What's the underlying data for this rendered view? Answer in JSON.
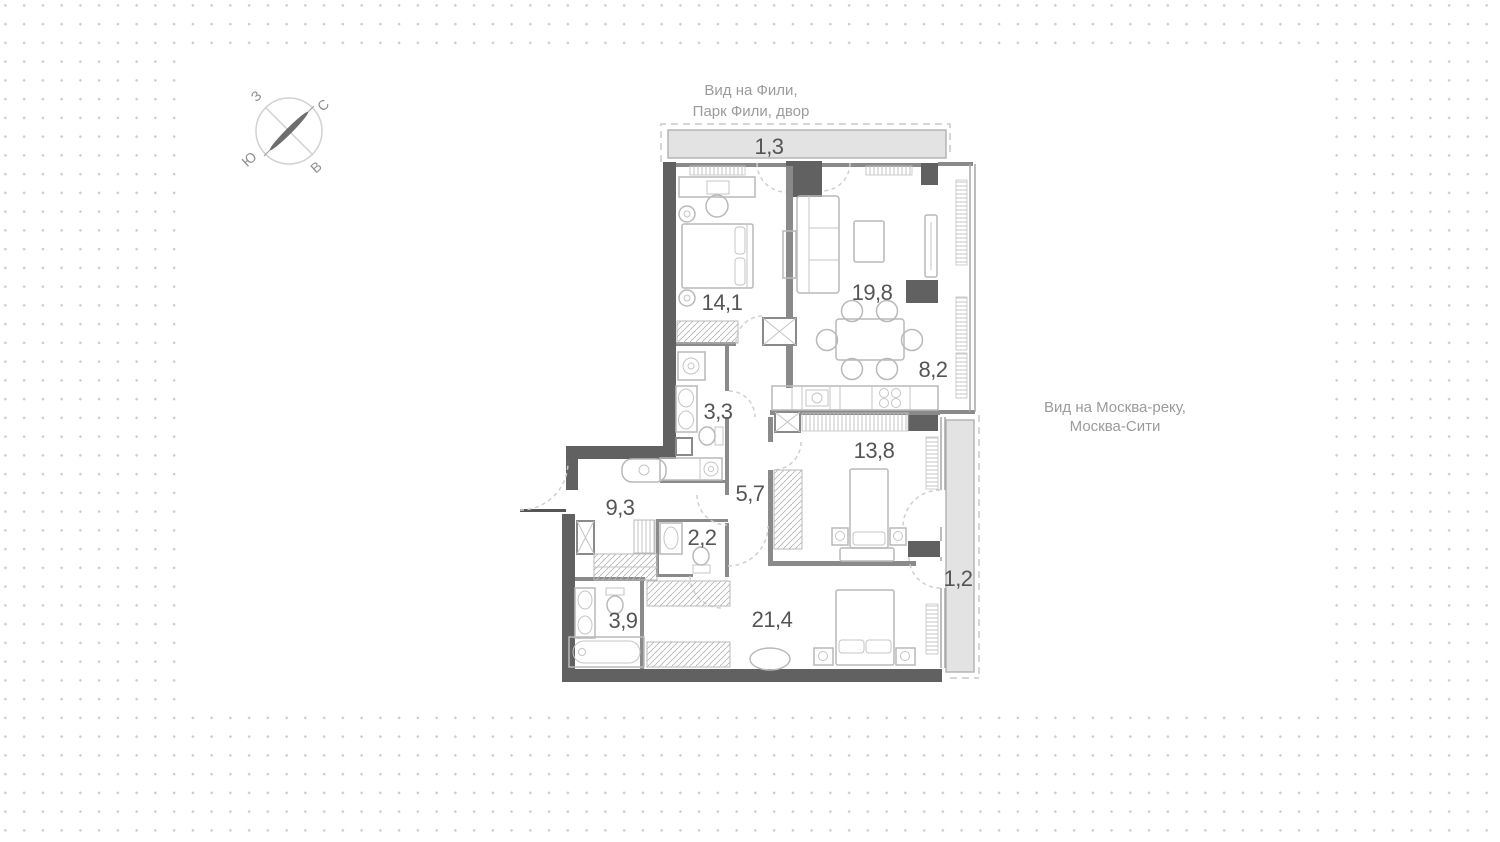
{
  "canvas": {
    "width": 1500,
    "height": 842
  },
  "colors": {
    "wall_dark": "#616161",
    "wall_mid": "#8a8a8a",
    "furniture_stroke": "#b9b9b9",
    "balcony_fill": "#e3e3e3",
    "dashed_line": "#cfcfcf",
    "room_label": "#555555",
    "view_text": "#9b9b9b",
    "background_dot": "#cbcbcb"
  },
  "compass": {
    "west": "З",
    "north": "С",
    "south": "Ю",
    "east": "В"
  },
  "views": {
    "top_line1": "Вид на Фили,",
    "top_line2": "Парк Фили, двор",
    "right_line1": "Вид на Москва-реку,",
    "right_line2": "Москва-Сити"
  },
  "rooms": [
    {
      "id": "balcony-top",
      "label": "1,3"
    },
    {
      "id": "bedroom-1",
      "label": "14,1"
    },
    {
      "id": "living-room",
      "label": "19,8"
    },
    {
      "id": "kitchen-zone",
      "label": "8,2"
    },
    {
      "id": "bathroom-1",
      "label": "3,3"
    },
    {
      "id": "bedroom-2",
      "label": "13,8"
    },
    {
      "id": "corridor",
      "label": "5,7"
    },
    {
      "id": "hallway",
      "label": "9,3"
    },
    {
      "id": "wc",
      "label": "2,2"
    },
    {
      "id": "bathroom-2",
      "label": "3,9"
    },
    {
      "id": "bedroom-3",
      "label": "21,4"
    },
    {
      "id": "balcony-right",
      "label": "1,2"
    }
  ]
}
